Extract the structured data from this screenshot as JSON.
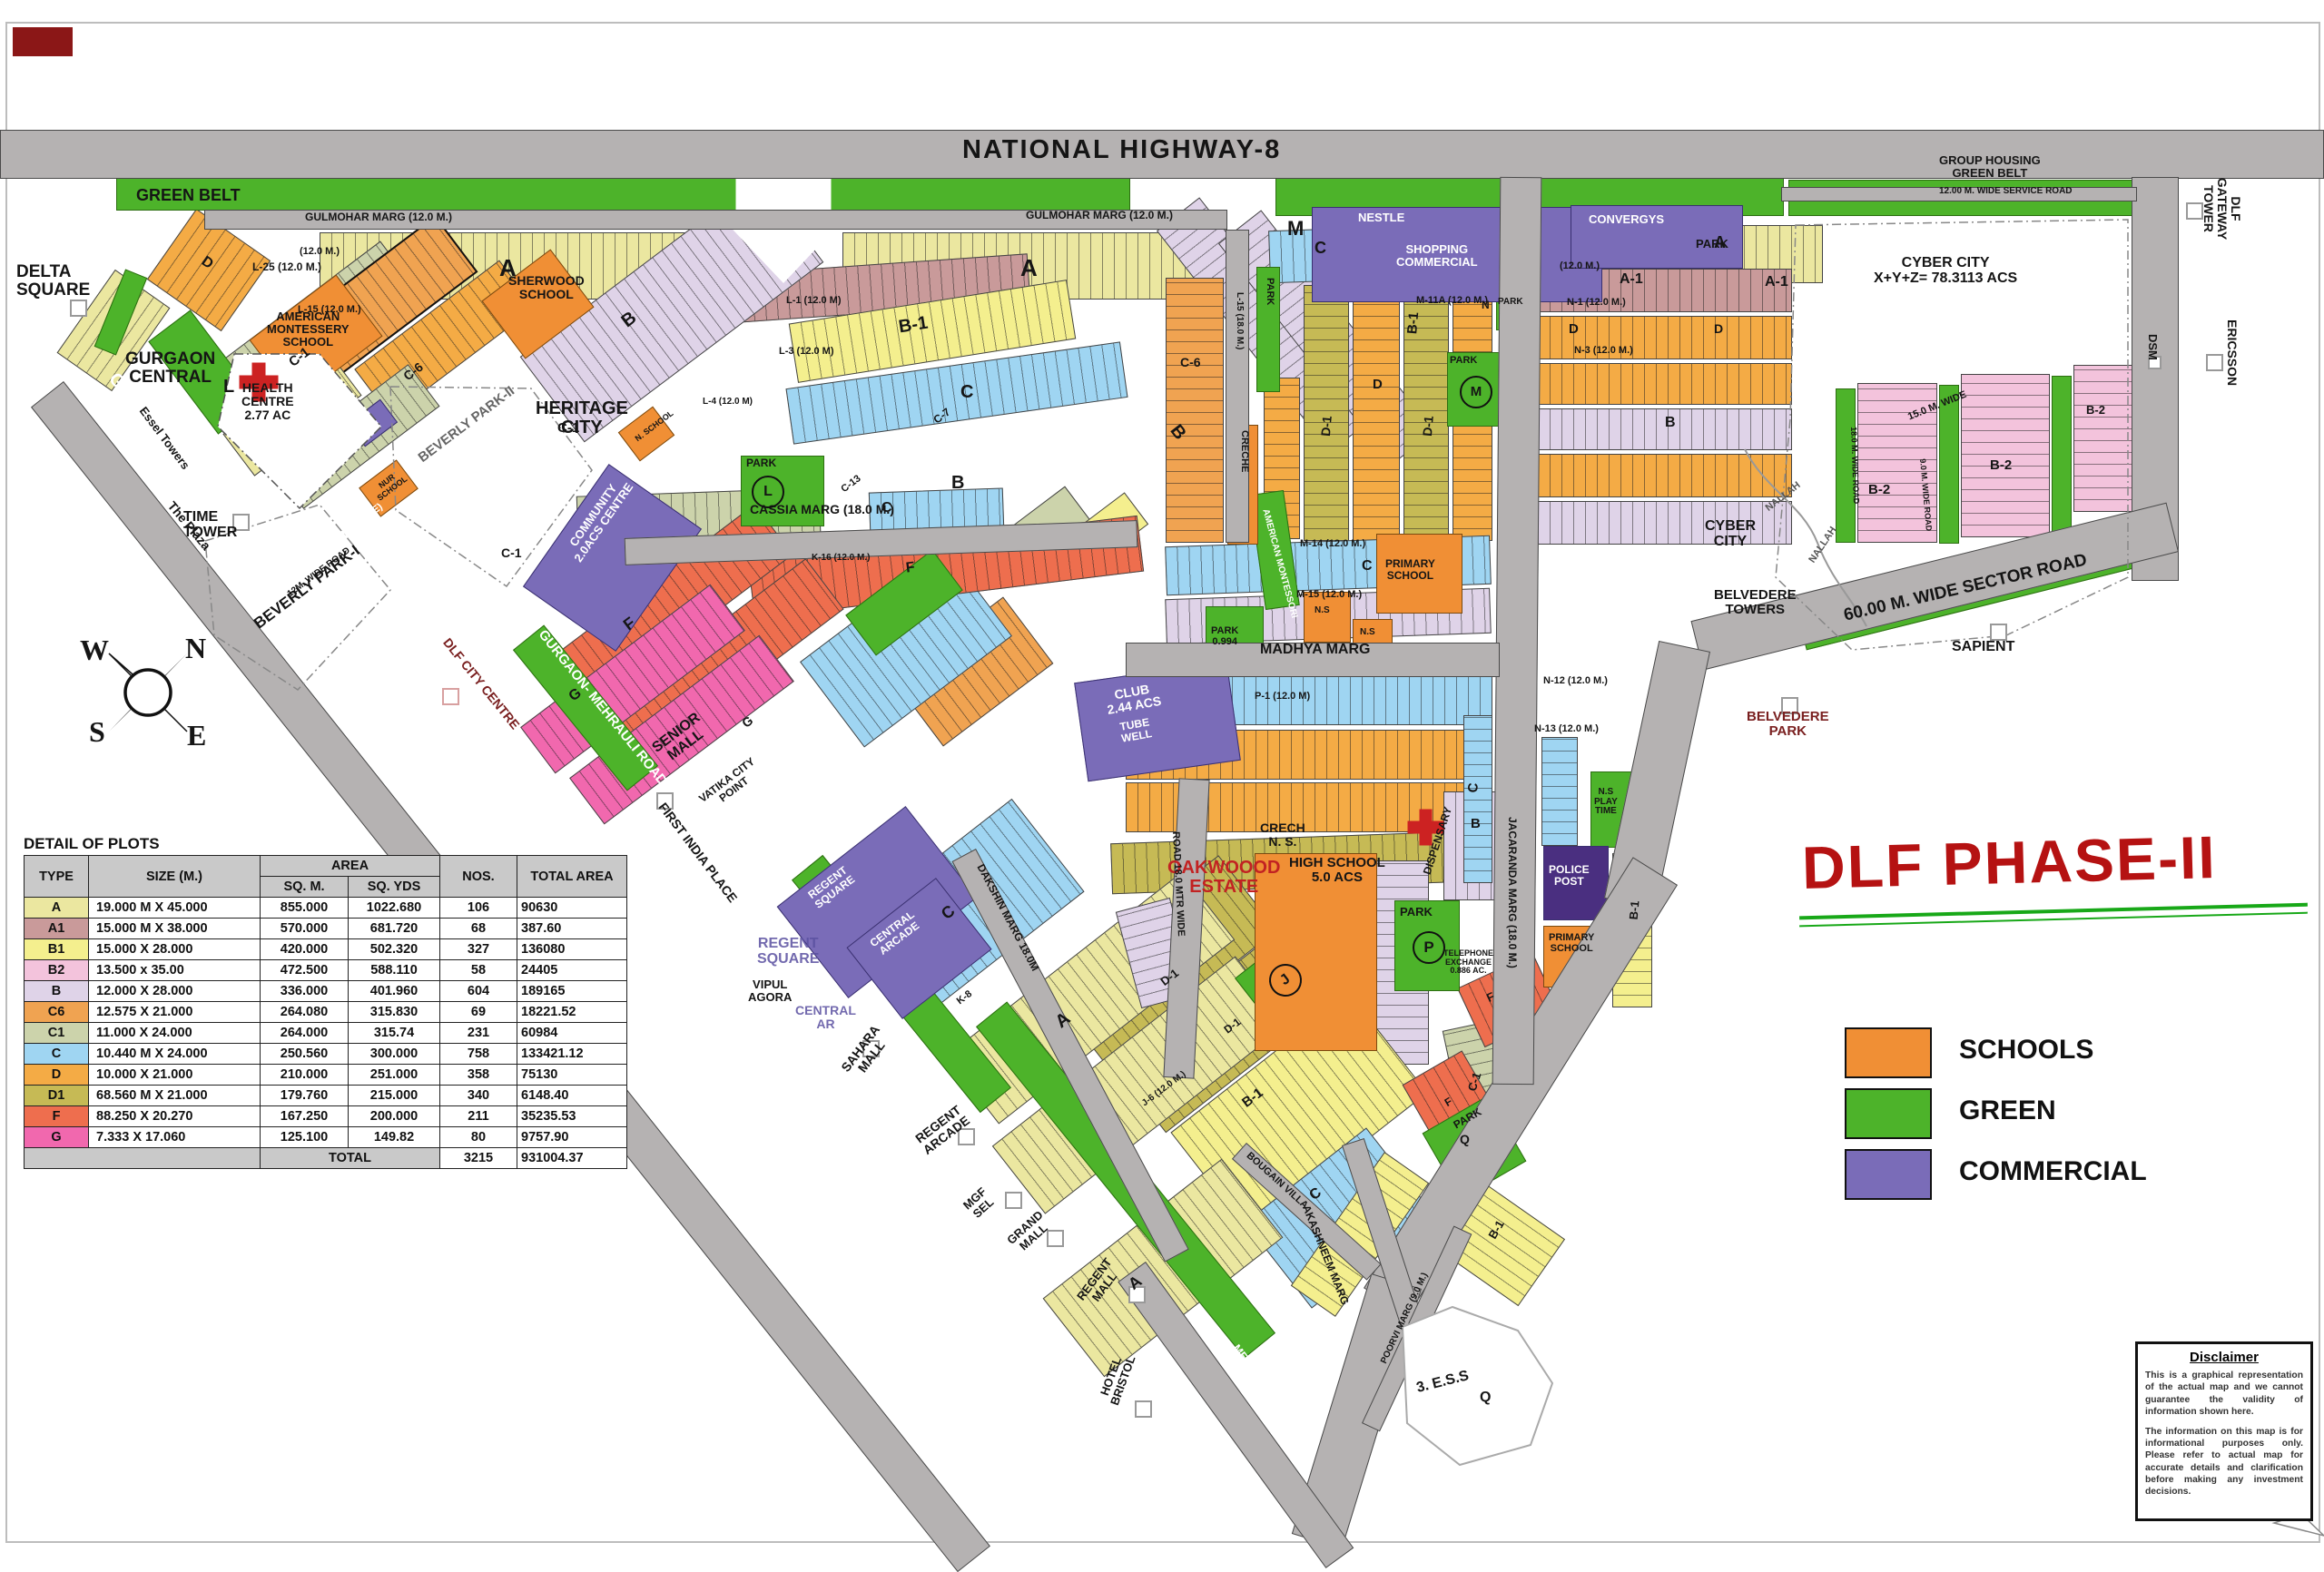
{
  "title": "DLF PHASE-II",
  "colors": {
    "road": "#b5b2b2",
    "green": "#4db32a",
    "commercial": "#7a6cb8",
    "schools": "#f08f35",
    "title_red": "#b51212",
    "title_green": "#18a818"
  },
  "legend": {
    "items": [
      {
        "label": "SCHOOLS",
        "color": "#f08f35"
      },
      {
        "label": "GREEN",
        "color": "#4db32a"
      },
      {
        "label": "COMMERCIAL",
        "color": "#7a6cb8"
      }
    ]
  },
  "compass": {
    "n": "N",
    "s": "S",
    "e": "E",
    "w": "W"
  },
  "plots_table": {
    "title": "DETAIL OF PLOTS",
    "headers": {
      "type": "TYPE",
      "size": "SIZE (M.)",
      "area": "AREA",
      "sqm": "SQ. M.",
      "sqyds": "SQ. YDS",
      "nos": "NOS.",
      "total": "TOTAL AREA"
    },
    "rows": [
      {
        "type": "A",
        "size": "19.000 M X 45.000",
        "sqm": "855.000",
        "sqyds": "1022.680",
        "nos": "106",
        "total": "90630"
      },
      {
        "type": "A1",
        "size": "15.000 M X 38.000",
        "sqm": "570.000",
        "sqyds": "681.720",
        "nos": "68",
        "total": "387.60"
      },
      {
        "type": "B1",
        "size": "15.000    X 28.000",
        "sqm": "420.000",
        "sqyds": "502.320",
        "nos": "327",
        "total": "136080"
      },
      {
        "type": "B2",
        "size": "13.500 x 35.00",
        "sqm": "472.500",
        "sqyds": "588.110",
        "nos": "58",
        "total": "24405"
      },
      {
        "type": "B",
        "size": "12.000    X 28.000",
        "sqm": "336.000",
        "sqyds": "401.960",
        "nos": "604",
        "total": "189165"
      },
      {
        "type": "C6",
        "size": "12.575    X 21.000",
        "sqm": "264.080",
        "sqyds": "315.830",
        "nos": "69",
        "total": "18221.52"
      },
      {
        "type": "C1",
        "size": "11.000    X 24.000",
        "sqm": "264.000",
        "sqyds": "315.74",
        "nos": "231",
        "total": "60984"
      },
      {
        "type": "C",
        "size": "10.440 M X 24.000",
        "sqm": "250.560",
        "sqyds": "300.000",
        "nos": "758",
        "total": "133421.12"
      },
      {
        "type": "D",
        "size": "10.000    X 21.000",
        "sqm": "210.000",
        "sqyds": "251.000",
        "nos": "358",
        "total": "75130"
      },
      {
        "type": "D1",
        "size": "68.560 M X 21.000",
        "sqm": "179.760",
        "sqyds": "215.000",
        "nos": "340",
        "total": "6148.40"
      },
      {
        "type": "F",
        "size": "88.250    X 20.270",
        "sqm": "167.250",
        "sqyds": "200.000",
        "nos": "211",
        "total": "35235.53"
      },
      {
        "type": "G",
        "size": "7.333      X 17.060",
        "sqm": "125.100",
        "sqyds": "149.82",
        "nos": "80",
        "total": "9757.90"
      }
    ],
    "total": {
      "label": "TOTAL",
      "nos": "3215",
      "area": "931004.37"
    }
  },
  "disclaimer": {
    "title": "Disclaimer",
    "p1": "This is a graphical representation of the actual map and we cannot guarantee the validity of information shown here.",
    "p2": "The information on this map is for informational purposes only. Please refer to actual map for accurate details and clarification before making any investment decisions."
  },
  "labels": [
    {
      "t": "NATIONAL HIGHWAY-8"
    },
    {
      "t": "GREEN BELT"
    },
    {
      "t": "GULMOHAR MARG (12.0 M.)"
    },
    {
      "t": "GULMOHAR MARG (12.0 M.)"
    },
    {
      "t": "DELTA\nSQUARE"
    },
    {
      "t": "GURGAON\nCENTRAL"
    },
    {
      "t": "GURGAON"
    },
    {
      "t": "The Plaza"
    },
    {
      "t": "Essel Towers"
    },
    {
      "t": "TIME\nTOWER"
    },
    {
      "t": "HEALTH\nCENTRE\n2.77 AC"
    },
    {
      "t": "L"
    },
    {
      "t": "AMERICAN\nMONTESSERY\nSCHOOL"
    },
    {
      "t": "SHERWOOD\nSCHOOL"
    },
    {
      "t": "HERITAGE\nCITY"
    },
    {
      "t": "BEVERLY PARK-I"
    },
    {
      "t": "GREEN BELT (30 M. WIDE)"
    },
    {
      "t": "12M. WIDE ROAD"
    },
    {
      "t": "BEVERLY PARK-II"
    },
    {
      "t": "COMMUNITY\n2.0ACS CENTRE"
    },
    {
      "t": "CASSIA MARG (18.0 M.)"
    },
    {
      "t": "SENIOR\nMALL"
    },
    {
      "t": "VATIKA CITY\nPOINT"
    },
    {
      "t": "DLF CITY CENTRE"
    },
    {
      "t": "GURGAON- MEHRAULI ROAD"
    },
    {
      "t": "FIRST INDIA PLACE"
    },
    {
      "t": "REGENT\nSQUARE"
    },
    {
      "t": "CENTRAL\nARCADE"
    },
    {
      "t": "REGENT\nSQUARE"
    },
    {
      "t": "VIPUL\nAGORA"
    },
    {
      "t": "CENTRAL\nAR"
    },
    {
      "t": "SAHARA\nMALL"
    },
    {
      "t": "REGENT\nARCADE"
    },
    {
      "t": "MGF\nSEL"
    },
    {
      "t": "GRAND\nMALL"
    },
    {
      "t": "REGENT\nMALL"
    },
    {
      "t": "HOTEL\nBRISTOL"
    },
    {
      "t": "MEHRAULI"
    },
    {
      "t": "OAKWOOOD\nESTATE"
    },
    {
      "t": "CRECH\nN. S."
    },
    {
      "t": "HIGH SCHOOL\n5.0 ACS"
    },
    {
      "t": "DISPENSARY"
    },
    {
      "t": "PARK"
    },
    {
      "t": "P"
    },
    {
      "t": "TELEPHONE\nEXCHANGE\n0.886 AC."
    },
    {
      "t": "MADHYA MARG"
    },
    {
      "t": "PARK\n0.994"
    },
    {
      "t": "JACARANDA MARG (18.0 M.)"
    },
    {
      "t": "DAKSHIN MARG 18.0M"
    },
    {
      "t": "AKASHNEEM MARG"
    },
    {
      "t": "BOUGAIN VILLA"
    },
    {
      "t": "POORVI MARG (9.0 M.)"
    },
    {
      "t": "ROAD 18.0 MTR WIDE"
    },
    {
      "t": "CLUB\n2.44 ACS"
    },
    {
      "t": "TUBE\nWELL"
    },
    {
      "t": "NESTLE"
    },
    {
      "t": "SHOPPING\nCOMMERCIAL"
    },
    {
      "t": "CONVERGYS"
    },
    {
      "t": "PARK"
    },
    {
      "t": "M"
    },
    {
      "t": "PARK"
    },
    {
      "t": "M"
    },
    {
      "t": "PARK"
    },
    {
      "t": "N"
    },
    {
      "t": "M-11A (12.0 M.)"
    },
    {
      "t": "N-1 (12.0 M.)"
    },
    {
      "t": "N-3 (12.0 M.)"
    },
    {
      "t": "GROUP HOUSING\nGREEN BELT"
    },
    {
      "t": "12.00 M. WIDE SERVICE ROAD"
    },
    {
      "t": "CYBER CITY\nX+Y+Z= 78.3113 ACS"
    },
    {
      "t": "DLF GATEWAY\nTOWER"
    },
    {
      "t": "ERICSSON"
    },
    {
      "t": "DSM"
    },
    {
      "t": "CYBER\nCITY"
    },
    {
      "t": "NALLAH"
    },
    {
      "t": "NALLAH"
    },
    {
      "t": "BELVEDERE\nTOWERS"
    },
    {
      "t": "BELVEDERE\nPARK"
    },
    {
      "t": "SAPIENT"
    },
    {
      "t": "60.00 M. WIDE SECTOR  ROAD"
    },
    {
      "t": "15.0 M. WIDE"
    },
    {
      "t": "18.0 M. WIDE ROAD"
    },
    {
      "t": "9.0 M. WIDE ROAD"
    },
    {
      "t": "B-2"
    },
    {
      "t": "B-2"
    },
    {
      "t": "B-2"
    },
    {
      "t": "3. E.S.S"
    },
    {
      "t": "Q"
    },
    {
      "t": "POLICE\nPOST"
    },
    {
      "t": "PRIMARY\nSCHOOL"
    },
    {
      "t": "PRIMARY\nSCHOOL"
    },
    {
      "t": "N.S\nPLAY\nTIME"
    },
    {
      "t": "L-25 (12.0 M.)"
    },
    {
      "t": "L-15 (12.0 M.)"
    },
    {
      "t": "L-1 (12.0 M)"
    },
    {
      "t": "L-3 (12.0 M)"
    },
    {
      "t": "L-4 (12.0 M)"
    },
    {
      "t": "P-1 (12.0 M)"
    },
    {
      "t": "M-14 (12.0 M.)"
    },
    {
      "t": "M-15 (12.0 M.)"
    },
    {
      "t": "N-12 (12.0 M.)"
    },
    {
      "t": "N-13 (12.0 M.)"
    },
    {
      "t": "K-16 (12.0 M.)"
    },
    {
      "t": "J-6 (12.0 M.)"
    },
    {
      "t": "AMERICAN MONTESSORI"
    },
    {
      "t": "N.S"
    },
    {
      "t": "N.S"
    },
    {
      "t": "NUR\nSCHOOL"
    },
    {
      "t": "N. SCHOOL"
    },
    {
      "t": "CRECHE"
    },
    {
      "t": "A"
    },
    {
      "t": "A"
    },
    {
      "t": "A"
    },
    {
      "t": "A-1"
    },
    {
      "t": "A-1"
    },
    {
      "t": "B-1"
    },
    {
      "t": "B-1"
    },
    {
      "t": "B-1"
    },
    {
      "t": "B-1"
    },
    {
      "t": "B-1"
    },
    {
      "t": "B"
    },
    {
      "t": "B"
    },
    {
      "t": "B"
    },
    {
      "t": "B"
    },
    {
      "t": "B"
    },
    {
      "t": "C"
    },
    {
      "t": "C"
    },
    {
      "t": "C"
    },
    {
      "t": "C"
    },
    {
      "t": "C"
    },
    {
      "t": "C"
    },
    {
      "t": "C"
    },
    {
      "t": "C-1"
    },
    {
      "t": "C-1"
    },
    {
      "t": "C-1"
    },
    {
      "t": "C-1"
    },
    {
      "t": "C-6"
    },
    {
      "t": "C-6"
    },
    {
      "t": "C-7"
    },
    {
      "t": "C-13"
    },
    {
      "t": "D"
    },
    {
      "t": "D"
    },
    {
      "t": "D"
    },
    {
      "t": "D"
    },
    {
      "t": "D-1"
    },
    {
      "t": "D-1"
    },
    {
      "t": "D-1"
    },
    {
      "t": "D-1"
    },
    {
      "t": "F"
    },
    {
      "t": "F"
    },
    {
      "t": "F"
    },
    {
      "t": "F"
    },
    {
      "t": "G"
    },
    {
      "t": "G"
    },
    {
      "t": "J"
    },
    {
      "t": "L"
    },
    {
      "t": "Q"
    },
    {
      "t": "K-8"
    },
    {
      "t": "A"
    },
    {
      "t": "A"
    },
    {
      "t": "PARK"
    },
    {
      "t": "PARK"
    },
    {
      "t": "PARK"
    },
    {
      "t": "L-15 (18.0 M.)"
    },
    {
      "t": "(12.0 M.)"
    },
    {
      "t": "(12.0 M.)"
    }
  ]
}
